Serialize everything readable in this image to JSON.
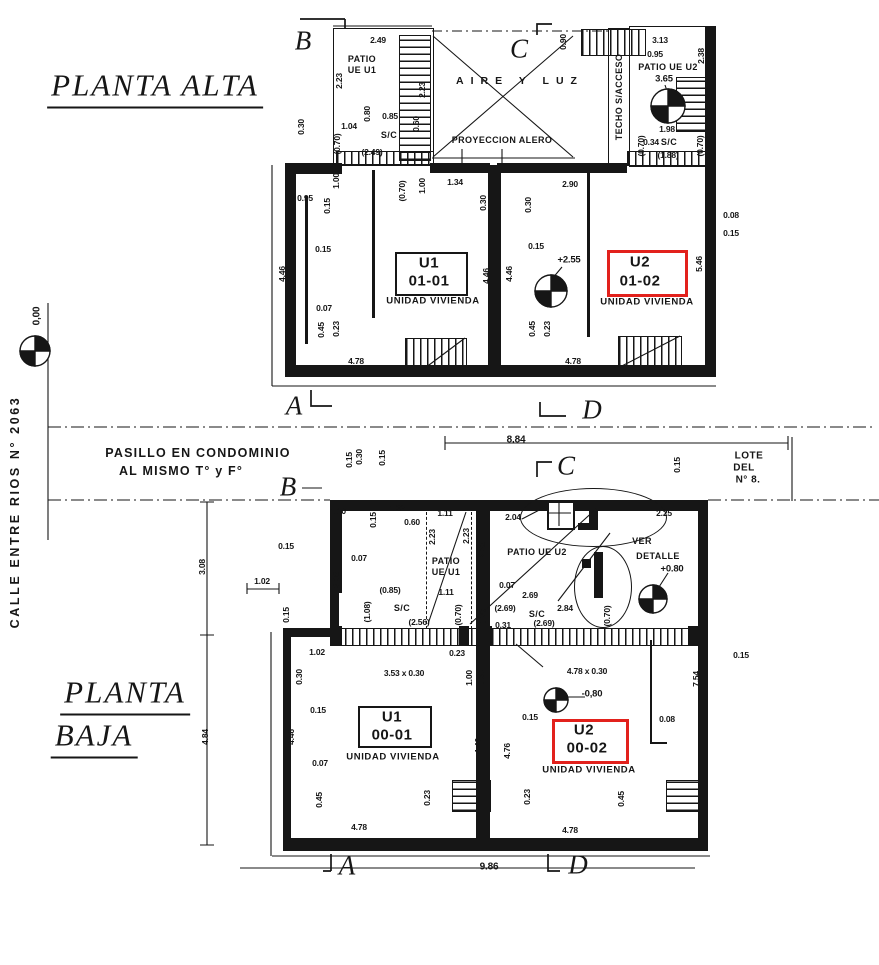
{
  "colors": {
    "ink": "#161616",
    "highlight_red": "#e2211c",
    "paper": "#ffffff"
  },
  "titles": {
    "upper": "PLANTA  ALTA",
    "lower_line1": "PLANTA",
    "lower_line2": "BAJA"
  },
  "street_label": "CALLE  ENTRE  RIOS    N° 2063",
  "labels": [
    {
      "t": "PLANTA  ALTA",
      "x": 155,
      "y": 88,
      "cls": "title",
      "n": "title-planta-alta"
    },
    {
      "t": "PLANTA",
      "x": 125,
      "y": 695,
      "cls": "title",
      "n": "title-planta-baja-line1"
    },
    {
      "t": "BAJA",
      "x": 94,
      "y": 738,
      "cls": "title",
      "n": "title-planta-baja-line2"
    },
    {
      "t": "CALLE  ENTRE  RIOS    N° 2063",
      "x": 15,
      "y": 512,
      "r": 1,
      "cls": "street",
      "n": "street-label"
    },
    {
      "t": "0,00",
      "x": 37,
      "y": 316,
      "r": 1,
      "cls": "dim10",
      "n": "level-label"
    },
    {
      "t": "PASILLO EN CONDOMINIO",
      "x": 198,
      "y": 453,
      "cls": "pas",
      "n": "pasillo-label"
    },
    {
      "t": "AL MISMO T°  y  F°",
      "x": 181,
      "y": 471,
      "cls": "pas",
      "n": "pasillo-label"
    },
    {
      "t": "LOTE",
      "x": 749,
      "y": 456,
      "cls": "lote",
      "n": "lot-label"
    },
    {
      "t": "DEL",
      "x": 744,
      "y": 468,
      "cls": "lote",
      "n": "lot-label"
    },
    {
      "t": "N° 8.",
      "x": 748,
      "y": 480,
      "cls": "lote",
      "n": "lot-label"
    },
    {
      "t": "8.84",
      "x": 516,
      "y": 440,
      "cls": "dim10"
    },
    {
      "t": "9.86",
      "x": 489,
      "y": 867,
      "cls": "dim10"
    },
    {
      "t": "B",
      "x": 303,
      "y": 41,
      "cls": "sec",
      "n": "section-letter-B"
    },
    {
      "t": "C",
      "x": 519,
      "y": 49,
      "cls": "sec",
      "n": "section-letter-C"
    },
    {
      "t": "A",
      "x": 294,
      "y": 406,
      "cls": "sec",
      "n": "section-letter-A"
    },
    {
      "t": "D",
      "x": 592,
      "y": 410,
      "cls": "sec",
      "n": "section-letter-D"
    },
    {
      "t": "B",
      "x": 288,
      "y": 487,
      "cls": "sec",
      "n": "section-letter-B"
    },
    {
      "t": "C",
      "x": 566,
      "y": 466,
      "cls": "sec",
      "n": "section-letter-C"
    },
    {
      "t": "A",
      "x": 347,
      "y": 866,
      "cls": "sec",
      "n": "section-letter-A"
    },
    {
      "t": "D",
      "x": 578,
      "y": 865,
      "cls": "sec",
      "n": "section-letter-D"
    },
    {
      "t": "AIRE Y LUZ",
      "x": 520,
      "y": 81,
      "cls": "air",
      "n": "area-label-aire-y-luz"
    },
    {
      "t": "PROYECCION ALERO",
      "x": 502,
      "y": 140,
      "cls": "patio",
      "n": "area-label"
    },
    {
      "t": "TECHO S/ACCESO",
      "x": 619,
      "y": 97,
      "r": 1,
      "cls": "patio",
      "n": "area-label"
    },
    {
      "t": "PATIO",
      "x": 362,
      "y": 59,
      "cls": "patio"
    },
    {
      "t": "UE U1",
      "x": 362,
      "y": 70,
      "cls": "patio"
    },
    {
      "t": "PATIO UE U2",
      "x": 668,
      "y": 67,
      "cls": "patio"
    },
    {
      "t": "2.49",
      "x": 378,
      "y": 40
    },
    {
      "t": "2.23",
      "x": 339,
      "y": 81,
      "r": 1
    },
    {
      "t": "2.23",
      "x": 422,
      "y": 90,
      "r": 1
    },
    {
      "t": "0.80",
      "x": 367,
      "y": 114,
      "r": 1
    },
    {
      "t": "0.85",
      "x": 390,
      "y": 116
    },
    {
      "t": "1.04",
      "x": 349,
      "y": 126
    },
    {
      "t": "0.60",
      "x": 416,
      "y": 124,
      "r": 1
    },
    {
      "t": "S/C",
      "x": 389,
      "y": 135,
      "cls": "patio"
    },
    {
      "t": "(2.49)",
      "x": 372,
      "y": 152,
      "cls": "p"
    },
    {
      "t": "(0.70)",
      "x": 337,
      "y": 144,
      "r": 1,
      "cls": "p"
    },
    {
      "t": "0.30",
      "x": 301,
      "y": 127,
      "r": 1
    },
    {
      "t": "0.90",
      "x": 563,
      "y": 42,
      "r": 1
    },
    {
      "t": "3.13",
      "x": 660,
      "y": 40
    },
    {
      "t": "0.95",
      "x": 655,
      "y": 54
    },
    {
      "t": "2.38",
      "x": 701,
      "y": 56,
      "r": 1
    },
    {
      "t": "3.65",
      "x": 664,
      "y": 79,
      "cls": "lvl",
      "n": "level-label"
    },
    {
      "t": "1.98",
      "x": 667,
      "y": 129
    },
    {
      "t": "(0.70)",
      "x": 641,
      "y": 146,
      "r": 1,
      "cls": "p"
    },
    {
      "t": "0.34",
      "x": 651,
      "y": 142
    },
    {
      "t": "S/C",
      "x": 669,
      "y": 142,
      "cls": "patio"
    },
    {
      "t": "(1.88)",
      "x": 668,
      "y": 155,
      "cls": "p"
    },
    {
      "t": "(0.70)",
      "x": 700,
      "y": 146,
      "r": 1,
      "cls": "p"
    },
    {
      "t": "0.95",
      "x": 305,
      "y": 198
    },
    {
      "t": "0.15",
      "x": 327,
      "y": 206,
      "r": 1
    },
    {
      "t": "1.00",
      "x": 336,
      "y": 181,
      "r": 1
    },
    {
      "t": "(0.70)",
      "x": 402,
      "y": 191,
      "r": 1,
      "cls": "p"
    },
    {
      "t": "1.00",
      "x": 422,
      "y": 186,
      "r": 1
    },
    {
      "t": "1.34",
      "x": 455,
      "y": 182
    },
    {
      "t": "0.30",
      "x": 483,
      "y": 203,
      "r": 1
    },
    {
      "t": "0.30",
      "x": 528,
      "y": 205,
      "r": 1
    },
    {
      "t": "2.90",
      "x": 570,
      "y": 184
    },
    {
      "t": "0.08",
      "x": 731,
      "y": 215
    },
    {
      "t": "0.15",
      "x": 731,
      "y": 233
    },
    {
      "t": "5.46",
      "x": 699,
      "y": 264,
      "r": 1
    },
    {
      "t": "0.15",
      "x": 323,
      "y": 249
    },
    {
      "t": "4.46",
      "x": 282,
      "y": 274,
      "r": 1
    },
    {
      "t": "U1",
      "x": 429,
      "y": 263,
      "cls": "room",
      "n": "room-id"
    },
    {
      "t": "01-01",
      "x": 429,
      "y": 281,
      "cls": "room",
      "n": "room-id"
    },
    {
      "t": "UNIDAD VIVIENDA",
      "x": 433,
      "y": 301,
      "cls": "sub",
      "n": "room-type-label"
    },
    {
      "t": "4.46",
      "x": 486,
      "y": 276,
      "r": 1
    },
    {
      "t": "4.46",
      "x": 509,
      "y": 274,
      "r": 1
    },
    {
      "t": "0.15",
      "x": 536,
      "y": 246
    },
    {
      "t": "+2.55",
      "x": 569,
      "y": 260,
      "cls": "lvl",
      "n": "level-label"
    },
    {
      "t": "U2",
      "x": 640,
      "y": 262,
      "cls": "room",
      "n": "room-id-highlighted"
    },
    {
      "t": "01-02",
      "x": 640,
      "y": 281,
      "cls": "room",
      "n": "room-id-highlighted"
    },
    {
      "t": "UNIDAD VIVIENDA",
      "x": 647,
      "y": 302,
      "cls": "sub",
      "n": "room-type-label"
    },
    {
      "t": "0.07",
      "x": 324,
      "y": 308
    },
    {
      "t": "0.45",
      "x": 321,
      "y": 330,
      "r": 1
    },
    {
      "t": "0.23",
      "x": 336,
      "y": 329,
      "r": 1
    },
    {
      "t": "4.78",
      "x": 356,
      "y": 361
    },
    {
      "t": "0.45",
      "x": 532,
      "y": 329,
      "r": 1
    },
    {
      "t": "0.23",
      "x": 547,
      "y": 329,
      "r": 1
    },
    {
      "t": "4.78",
      "x": 573,
      "y": 361
    },
    {
      "t": "0.15",
      "x": 349,
      "y": 460,
      "r": 1
    },
    {
      "t": "0.30",
      "x": 359,
      "y": 457,
      "r": 1
    },
    {
      "t": "0.15",
      "x": 382,
      "y": 458,
      "r": 1
    },
    {
      "t": "0.15",
      "x": 677,
      "y": 465,
      "r": 1
    },
    {
      "t": "1.10",
      "x": 338,
      "y": 511
    },
    {
      "t": "0.15",
      "x": 373,
      "y": 520,
      "r": 1
    },
    {
      "t": "1.32",
      "x": 397,
      "y": 508
    },
    {
      "t": "0.60",
      "x": 412,
      "y": 522
    },
    {
      "t": "1.11",
      "x": 445,
      "y": 513
    },
    {
      "t": "2.23",
      "x": 432,
      "y": 537,
      "r": 1
    },
    {
      "t": "2.23",
      "x": 466,
      "y": 536,
      "r": 1
    },
    {
      "t": "2.04",
      "x": 513,
      "y": 517
    },
    {
      "t": "2.23",
      "x": 482,
      "y": 550,
      "r": 1
    },
    {
      "t": "PATIO UE U2",
      "x": 537,
      "y": 552,
      "cls": "patio"
    },
    {
      "t": "PATIO",
      "x": 446,
      "y": 561,
      "cls": "patio"
    },
    {
      "t": "UE U1",
      "x": 446,
      "y": 572,
      "cls": "patio"
    },
    {
      "t": "0.07",
      "x": 507,
      "y": 585
    },
    {
      "t": "2.69",
      "x": 530,
      "y": 595
    },
    {
      "t": "1.11",
      "x": 446,
      "y": 592
    },
    {
      "t": "(0.85)",
      "x": 390,
      "y": 590,
      "cls": "p"
    },
    {
      "t": "(1.08)",
      "x": 367,
      "y": 612,
      "r": 1,
      "cls": "p"
    },
    {
      "t": "S/C",
      "x": 402,
      "y": 608,
      "cls": "patio"
    },
    {
      "t": "(2.56)",
      "x": 419,
      "y": 622,
      "cls": "p"
    },
    {
      "t": "(0.70)",
      "x": 458,
      "y": 615,
      "r": 1,
      "cls": "p"
    },
    {
      "t": "0.70",
      "x": 483,
      "y": 617,
      "r": 1
    },
    {
      "t": "(2.69)",
      "x": 505,
      "y": 608,
      "cls": "p"
    },
    {
      "t": "S/C",
      "x": 537,
      "y": 614,
      "cls": "patio"
    },
    {
      "t": "2.84",
      "x": 565,
      "y": 608
    },
    {
      "t": "(2.69)",
      "x": 544,
      "y": 623,
      "cls": "p"
    },
    {
      "t": "0.31",
      "x": 503,
      "y": 625
    },
    {
      "t": "(0.70)",
      "x": 607,
      "y": 616,
      "r": 1,
      "cls": "p"
    },
    {
      "t": "2.25",
      "x": 664,
      "y": 513
    },
    {
      "t": "VER",
      "x": 642,
      "y": 541,
      "cls": "patio",
      "n": "detail-note"
    },
    {
      "t": "DETALLE",
      "x": 658,
      "y": 556,
      "cls": "patio",
      "n": "detail-note"
    },
    {
      "t": "+0.80",
      "x": 672,
      "y": 569,
      "cls": "lvl",
      "n": "level-label"
    },
    {
      "t": "0.15",
      "x": 286,
      "y": 546
    },
    {
      "t": "0.07",
      "x": 359,
      "y": 558
    },
    {
      "t": "3.08",
      "x": 336,
      "y": 580,
      "r": 1
    },
    {
      "t": "3.08",
      "x": 202,
      "y": 567,
      "r": 1
    },
    {
      "t": "1.02",
      "x": 262,
      "y": 581
    },
    {
      "t": "0.15",
      "x": 286,
      "y": 615,
      "r": 1
    },
    {
      "t": "1.02",
      "x": 317,
      "y": 652
    },
    {
      "t": "0.30",
      "x": 299,
      "y": 677,
      "r": 1
    },
    {
      "t": "0.15",
      "x": 318,
      "y": 710
    },
    {
      "t": "4.46",
      "x": 291,
      "y": 737,
      "r": 1
    },
    {
      "t": "0.07",
      "x": 320,
      "y": 763
    },
    {
      "t": "0.45",
      "x": 319,
      "y": 800,
      "r": 1
    },
    {
      "t": "4.84",
      "x": 205,
      "y": 737,
      "r": 1
    },
    {
      "t": "3.53 x 0.30",
      "x": 404,
      "y": 673
    },
    {
      "t": "0.23",
      "x": 457,
      "y": 653
    },
    {
      "t": "1.00",
      "x": 469,
      "y": 678,
      "r": 1
    },
    {
      "t": "0.30",
      "x": 481,
      "y": 678,
      "r": 1
    },
    {
      "t": "4.78 x 0.30",
      "x": 587,
      "y": 671
    },
    {
      "t": "-0,80",
      "x": 592,
      "y": 694,
      "cls": "lvl",
      "n": "level-label"
    },
    {
      "t": "0.15",
      "x": 530,
      "y": 717
    },
    {
      "t": "U1",
      "x": 392,
      "y": 717,
      "cls": "room",
      "n": "room-id"
    },
    {
      "t": "00-01",
      "x": 392,
      "y": 735,
      "cls": "room",
      "n": "room-id"
    },
    {
      "t": "UNIDAD VIVIENDA",
      "x": 393,
      "y": 757,
      "cls": "sub",
      "n": "room-type-label"
    },
    {
      "t": "4.46",
      "x": 478,
      "y": 746,
      "r": 1
    },
    {
      "t": "4.76",
      "x": 507,
      "y": 751,
      "r": 1
    },
    {
      "t": "U2",
      "x": 584,
      "y": 730,
      "cls": "room",
      "n": "room-id-highlighted"
    },
    {
      "t": "00-02",
      "x": 587,
      "y": 748,
      "cls": "room",
      "n": "room-id-highlighted"
    },
    {
      "t": "UNIDAD VIVIENDA",
      "x": 589,
      "y": 770,
      "cls": "sub",
      "n": "room-type-label"
    },
    {
      "t": "0.15",
      "x": 741,
      "y": 655
    },
    {
      "t": "7.54",
      "x": 696,
      "y": 679,
      "r": 1
    },
    {
      "t": "0.08",
      "x": 667,
      "y": 719
    },
    {
      "t": "0.23",
      "x": 427,
      "y": 798,
      "r": 1
    },
    {
      "t": "4.78",
      "x": 359,
      "y": 827
    },
    {
      "t": "0.23",
      "x": 527,
      "y": 797,
      "r": 1
    },
    {
      "t": "0.45",
      "x": 621,
      "y": 799,
      "r": 1
    },
    {
      "t": "4.78",
      "x": 570,
      "y": 830
    }
  ]
}
